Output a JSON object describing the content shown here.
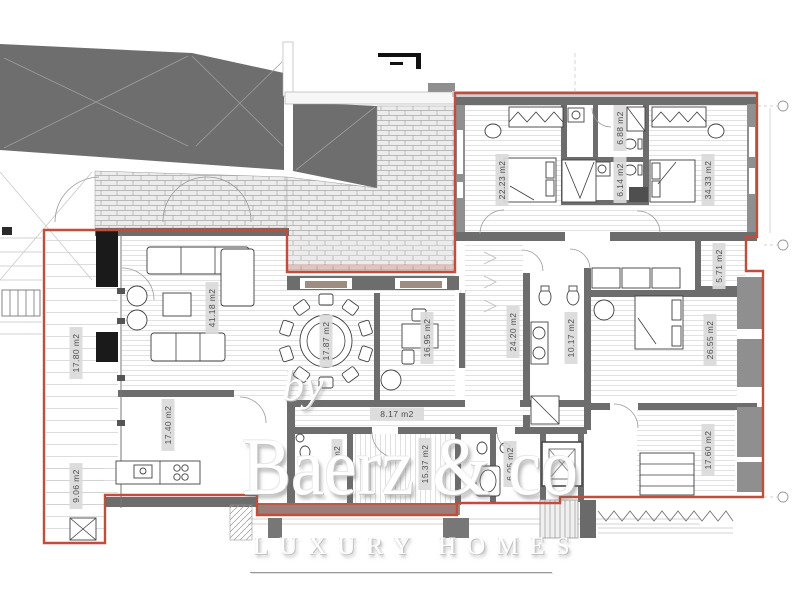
{
  "watermark": {
    "by": "by",
    "name": "Baerz & co",
    "tagline": "LUXURY HOMES"
  },
  "rooms": [
    {
      "id": "terrace",
      "area": "17.80 m2"
    },
    {
      "id": "living-room",
      "area": "41.18 m2"
    },
    {
      "id": "dining-room",
      "area": "17.87 m2"
    },
    {
      "id": "study",
      "area": "16.95 m2"
    },
    {
      "id": "hallway",
      "area": "24.20 m2"
    },
    {
      "id": "bathroom-main",
      "area": "10.17 m2"
    },
    {
      "id": "master-bedroom",
      "area": "26.55 m2"
    },
    {
      "id": "bedroom-2",
      "area": "22.23 m2"
    },
    {
      "id": "bathroom-2",
      "area": "6.88 m2"
    },
    {
      "id": "bathroom-3",
      "area": "6.14 m2"
    },
    {
      "id": "bedroom-3",
      "area": "34.33 m2"
    },
    {
      "id": "walk-in-closet",
      "area": "5.71 m2"
    },
    {
      "id": "corridor",
      "area": "8.17 m2"
    },
    {
      "id": "kitchen",
      "area": "17.40 m2"
    },
    {
      "id": "terrace-lower",
      "area": "9.06 m2"
    },
    {
      "id": "inner-hall",
      "area": "15.37 m2"
    },
    {
      "id": "bathroom-4",
      "area": "6.05 m2"
    },
    {
      "id": "bedroom-4",
      "area": "17.60 m2"
    },
    {
      "id": "wc",
      "area": "m2"
    }
  ],
  "colors": {
    "boundary": "#bf4e3a",
    "wall": "#6d6d6d",
    "roof": "#6e6e6e",
    "label_bg": "#dadada",
    "label_text": "#4d4d4d",
    "watermark_text": "#ffffff"
  }
}
